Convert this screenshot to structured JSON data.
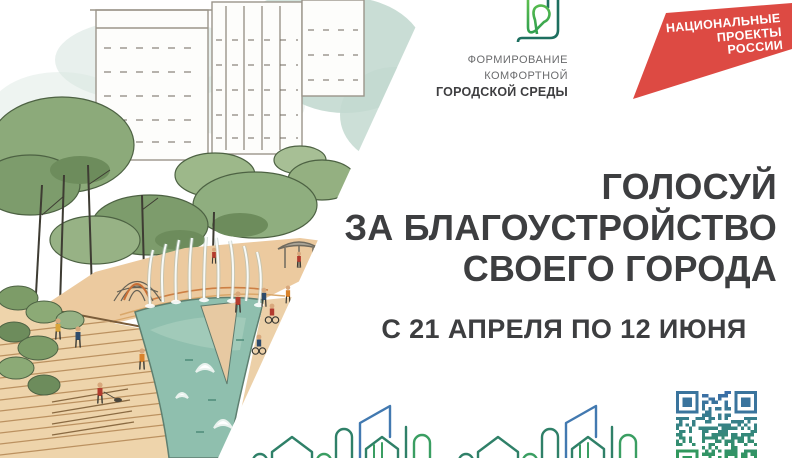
{
  "poster": {
    "background": "#ffffff"
  },
  "fkgs_logo": {
    "line1": "ФОРМИРОВАНИЕ",
    "line2": "КОМФОРТНОЙ",
    "line3": "ГОРОДСКОЙ СРЕДЫ",
    "green": "#47ab4e",
    "teal": "#1d6f5f"
  },
  "np_logo": {
    "line1": "НАЦИОНАЛЬНЫЕ",
    "line2": "ПРОЕКТЫ",
    "line3": "РОССИИ",
    "red": "#dd4a43"
  },
  "headline": {
    "line1": "ГОЛОСУЙ",
    "line2": "ЗА БЛАГОУСТРОЙСТВО",
    "line3": "СВОЕГО ГОРОДА",
    "color": "#3d3e40"
  },
  "dates": {
    "text": "С 21 АПРЕЛЯ ПО 12 ИЮНЯ"
  },
  "skyline": {
    "teal": "#2f8068",
    "green": "#3a9e62",
    "blue": "#4279b0"
  },
  "qr": {
    "color_top": "#3b6ea8",
    "color_bottom": "#2f9e53"
  }
}
